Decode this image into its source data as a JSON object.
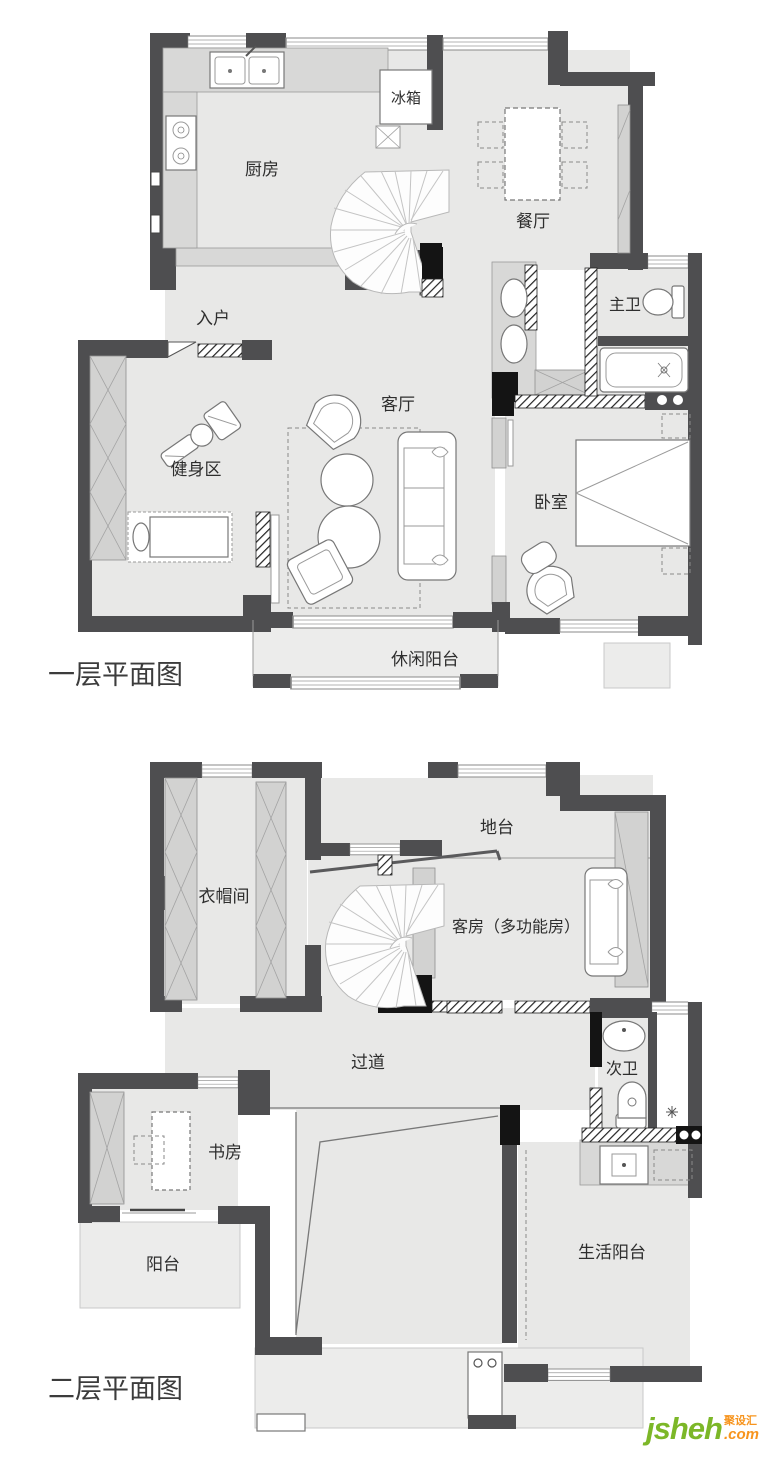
{
  "floor1": {
    "title": "一层平面图",
    "rooms": {
      "kitchen": "厨房",
      "fridge": "冰箱",
      "dining": "餐厅",
      "entry": "入户",
      "master_bath": "主卫",
      "living": "客厅",
      "gym": "健身区",
      "bedroom": "卧室",
      "leisure_balcony": "休闲阳台"
    }
  },
  "floor2": {
    "title": "二层平面图",
    "rooms": {
      "platform": "地台",
      "cloakroom": "衣帽间",
      "guest_room": "客房（多功能房）",
      "corridor": "过道",
      "second_bath": "次卫",
      "study": "书房",
      "balcony": "阳台",
      "living_balcony": "生活阳台"
    }
  },
  "watermark": {
    "brand": "jsheh",
    "tld": ".com",
    "cn_name": "聚设汇"
  },
  "palette": {
    "wall": "#4e4e50",
    "floor": "#e8e8e7",
    "cabinet": "#d2d2d1",
    "brand_green": "#7cb728",
    "brand_orange": "#f7941d"
  }
}
